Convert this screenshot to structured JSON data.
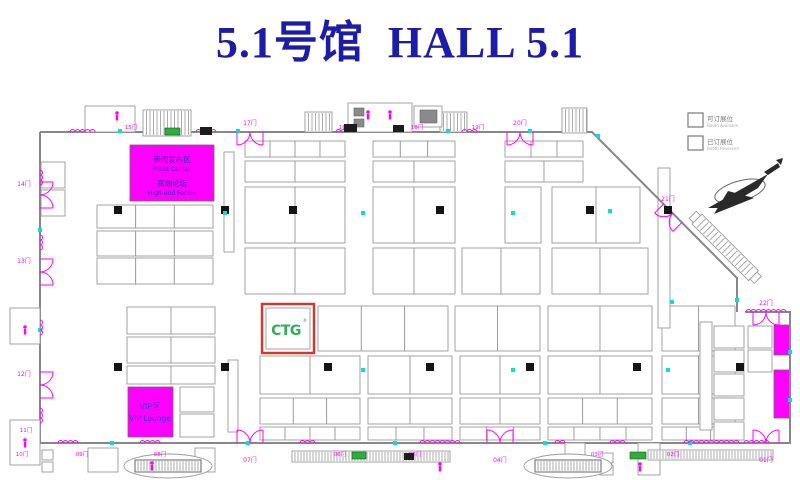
{
  "title": {
    "text": "5.1号馆  HALL 5.1",
    "color": "#1c1ca8"
  },
  "colors": {
    "title_blue": "#1c1ca8",
    "cad_magenta": "#ff00ff",
    "wall_gray": "#878787",
    "booth_gray": "#9a9a9a",
    "highlight_red": "#cf3a30",
    "ctg_green": "#2eb05a",
    "area_text_blue": "#2b2bb4",
    "cyan_marker": "#00dfe8"
  },
  "legend": {
    "items": [
      {
        "cn": "可订展位",
        "en": "Booth Available"
      },
      {
        "cn": "已订展位",
        "en": "Booth Reserved"
      }
    ]
  },
  "press_center": {
    "line1": "新闻发布区",
    "line2": "Press Center",
    "line3": "高端论坛",
    "line4": "High-end Forum"
  },
  "vip_lounge": {
    "line1": "VIP区",
    "line2": "VIP Lounge"
  },
  "ctg_booth": {
    "logo": "CTG",
    "reg": "®"
  },
  "floorplan": {
    "walls": [
      "M40,132 H592 L737,278 V312",
      "M745,312 H790 V443 H40 V132"
    ],
    "booth_rows": [
      {
        "y": 141,
        "h": 16,
        "groups": [
          [
            245,
            100,
            4
          ],
          [
            373,
            82,
            3
          ],
          [
            505,
            78,
            3
          ]
        ]
      },
      {
        "y": 161,
        "h": 21,
        "groups": [
          [
            245,
            100,
            2
          ],
          [
            373,
            82,
            2
          ],
          [
            505,
            78,
            2
          ]
        ]
      },
      {
        "y": 187,
        "h": 56,
        "groups": [
          [
            245,
            100,
            2
          ],
          [
            373,
            82,
            2
          ],
          [
            505,
            36,
            1
          ],
          [
            552,
            88,
            2
          ]
        ]
      },
      {
        "y": 248,
        "h": 46,
        "groups": [
          [
            245,
            100,
            2
          ],
          [
            373,
            82,
            2
          ],
          [
            462,
            78,
            2
          ],
          [
            552,
            96,
            2
          ]
        ]
      },
      {
        "y": 306,
        "h": 45,
        "groups": [
          [
            318,
            130,
            3
          ],
          [
            455,
            85,
            2
          ],
          [
            548,
            104,
            2
          ],
          [
            662,
            73,
            2
          ]
        ]
      },
      {
        "y": 356,
        "h": 38,
        "groups": [
          [
            260,
            100,
            2
          ],
          [
            368,
            84,
            2
          ],
          [
            460,
            80,
            2
          ],
          [
            548,
            104,
            2
          ],
          [
            662,
            73,
            2
          ]
        ]
      },
      {
        "y": 398,
        "h": 26,
        "groups": [
          [
            260,
            100,
            3
          ],
          [
            368,
            84,
            2
          ],
          [
            460,
            80,
            2
          ],
          [
            548,
            104,
            3
          ],
          [
            662,
            73,
            2
          ]
        ]
      },
      {
        "y": 427,
        "h": 13,
        "groups": [
          [
            260,
            100,
            4
          ],
          [
            368,
            84,
            3
          ],
          [
            460,
            80,
            3
          ],
          [
            548,
            104,
            4
          ],
          [
            662,
            73,
            3
          ]
        ]
      },
      {
        "y": 205,
        "h": 23,
        "groups": [
          [
            97,
            116,
            3
          ]
        ]
      },
      {
        "y": 231,
        "h": 25,
        "groups": [
          [
            97,
            116,
            3
          ]
        ]
      },
      {
        "y": 258,
        "h": 26,
        "groups": [
          [
            97,
            116,
            3
          ]
        ]
      },
      {
        "y": 307,
        "h": 27,
        "groups": [
          [
            127,
            88,
            2
          ]
        ]
      },
      {
        "y": 337,
        "h": 26,
        "groups": [
          [
            127,
            88,
            2
          ]
        ]
      },
      {
        "y": 366,
        "h": 18,
        "groups": [
          [
            127,
            88,
            2
          ]
        ]
      }
    ],
    "booths_extra": [
      [
        180,
        387,
        34,
        25
      ],
      [
        180,
        414,
        34,
        23
      ],
      [
        714,
        326,
        30,
        22
      ],
      [
        714,
        350,
        30,
        22
      ],
      [
        714,
        374,
        30,
        22
      ],
      [
        714,
        398,
        30,
        22
      ],
      [
        748,
        326,
        24,
        22
      ],
      [
        748,
        350,
        24,
        22
      ],
      [
        714,
        422,
        30,
        18
      ],
      [
        41,
        162,
        24,
        26
      ],
      [
        41,
        190,
        24,
        26
      ]
    ],
    "narrow_rects": [
      [
        224,
        152,
        10,
        100
      ],
      [
        658,
        168,
        12,
        160
      ],
      [
        228,
        360,
        10,
        72
      ],
      [
        700,
        322,
        12,
        108
      ]
    ],
    "press_rect": [
      130,
      145,
      84,
      56
    ],
    "vip_rect": [
      128,
      387,
      45,
      50
    ],
    "ctg_rect": [
      262,
      304,
      52,
      49
    ],
    "magenta_bars": [
      [
        774,
        325,
        16,
        30
      ],
      [
        774,
        370,
        16,
        48
      ]
    ],
    "hatch_blocks": [
      [
        143,
        110,
        48,
        26
      ],
      [
        305,
        112,
        27,
        20
      ],
      [
        440,
        112,
        27,
        20
      ],
      [
        562,
        108,
        25,
        25
      ]
    ],
    "structures": [
      [
        85,
        106,
        50,
        26
      ],
      [
        348,
        103,
        64,
        29
      ],
      [
        414,
        106,
        28,
        21
      ],
      [
        10,
        308,
        30,
        36
      ],
      [
        10,
        420,
        30,
        45
      ],
      [
        88,
        448,
        30,
        24
      ],
      [
        195,
        448,
        20,
        24
      ],
      [
        565,
        443,
        20,
        32
      ],
      [
        638,
        443,
        22,
        32
      ],
      [
        42,
        450,
        11,
        10
      ],
      [
        42,
        462,
        11,
        10
      ],
      [
        600,
        453,
        13,
        10
      ],
      [
        600,
        465,
        13,
        10
      ]
    ],
    "dark_rects": [
      [
        354,
        108,
        10,
        8
      ],
      [
        354,
        119,
        10,
        8
      ],
      [
        420,
        110,
        17,
        13
      ]
    ],
    "walkways": [
      [
        292,
        451,
        158,
        11
      ],
      [
        648,
        450,
        125,
        10
      ]
    ],
    "ovals": [
      [
        168,
        466,
        44,
        12
      ],
      [
        568,
        466,
        44,
        12
      ]
    ],
    "diag_escalator": {
      "x": 692,
      "y": 224,
      "w": 14,
      "len": 80
    },
    "pillars": [
      [
        118,
        210
      ],
      [
        225,
        210
      ],
      [
        293,
        210
      ],
      [
        440,
        210
      ],
      [
        590,
        210
      ],
      [
        668,
        210
      ],
      [
        118,
        367
      ],
      [
        225,
        367
      ],
      [
        328,
        367
      ],
      [
        430,
        367
      ],
      [
        530,
        367
      ],
      [
        637,
        367
      ],
      [
        740,
        367
      ]
    ],
    "cyan_dots": [
      [
        120,
        131
      ],
      [
        238,
        131
      ],
      [
        448,
        131
      ],
      [
        530,
        131
      ],
      [
        598,
        136
      ],
      [
        112,
        443
      ],
      [
        248,
        443
      ],
      [
        395,
        443
      ],
      [
        545,
        443
      ],
      [
        690,
        443
      ],
      [
        40,
        230
      ],
      [
        40,
        330
      ],
      [
        790,
        352
      ],
      [
        790,
        400
      ],
      [
        296,
        311
      ],
      [
        610,
        211
      ],
      [
        672,
        302
      ],
      [
        737,
        300
      ],
      [
        225,
        213
      ],
      [
        668,
        370
      ],
      [
        363,
        213
      ],
      [
        513,
        213
      ],
      [
        363,
        370
      ],
      [
        513,
        370
      ]
    ],
    "squiggles_h": [
      [
        70,
        132,
        26
      ],
      [
        196,
        132,
        20
      ],
      [
        336,
        132,
        16
      ],
      [
        462,
        132,
        16
      ],
      [
        58,
        443,
        24
      ],
      [
        140,
        443,
        20
      ],
      [
        300,
        443,
        16
      ],
      [
        420,
        443,
        40
      ],
      [
        555,
        443,
        14
      ],
      [
        610,
        443,
        16
      ],
      [
        684,
        443,
        56
      ],
      [
        744,
        443,
        28
      ],
      [
        746,
        312,
        40
      ]
    ],
    "squiggles_v": [
      [
        40,
        170,
        18
      ],
      [
        40,
        235,
        18
      ],
      [
        40,
        320,
        18
      ],
      [
        40,
        408,
        18
      ]
    ],
    "gates_big": [
      {
        "x": 250,
        "y": 132,
        "flip": 1,
        "rot": 0,
        "label": "17门",
        "lx": 250,
        "ly": 125
      },
      {
        "x": 520,
        "y": 132,
        "flip": 1,
        "rot": 0,
        "label": "20门",
        "lx": 520,
        "ly": 125
      },
      {
        "x": 250,
        "y": 443,
        "flip": -1,
        "rot": 0,
        "label": "07门",
        "lx": 250,
        "ly": 462
      },
      {
        "x": 500,
        "y": 443,
        "flip": -1,
        "rot": 0,
        "label": "04门",
        "lx": 500,
        "ly": 462
      },
      {
        "x": 766,
        "y": 443,
        "flip": -1,
        "rot": 0,
        "label": "01门",
        "lx": 766,
        "ly": 462
      },
      {
        "x": 766,
        "y": 312,
        "flip": 1,
        "rot": 0,
        "label": "22门",
        "lx": 766,
        "ly": 305
      },
      {
        "x": 673,
        "y": 213,
        "flip": 1,
        "rot": 45,
        "label": "21门",
        "lx": 668,
        "ly": 201
      },
      {
        "x": 40,
        "y": 195,
        "flip": 1,
        "rot": -90,
        "label": "14门",
        "lx": 24,
        "ly": 186
      },
      {
        "x": 40,
        "y": 272,
        "flip": 1,
        "rot": -90,
        "label": "13门",
        "lx": 24,
        "ly": 263
      },
      {
        "x": 40,
        "y": 385,
        "flip": 1,
        "rot": -90,
        "label": "12门",
        "lx": 24,
        "ly": 376
      }
    ],
    "doors_small": [
      {
        "x": 131,
        "y": 129,
        "label": "15门"
      },
      {
        "x": 345,
        "y": 129,
        "label": "16门"
      },
      {
        "x": 417,
        "y": 129,
        "label": "18门"
      },
      {
        "x": 478,
        "y": 129,
        "label": "19门"
      },
      {
        "x": 22,
        "y": 456,
        "label": "10门"
      },
      {
        "x": 82,
        "y": 456,
        "label": "09门"
      },
      {
        "x": 160,
        "y": 456,
        "label": "08门"
      },
      {
        "x": 340,
        "y": 456,
        "label": "06门"
      },
      {
        "x": 415,
        "y": 456,
        "label": "05门"
      },
      {
        "x": 597,
        "y": 456,
        "label": "03门"
      },
      {
        "x": 673,
        "y": 456,
        "label": "02门"
      },
      {
        "x": 26,
        "y": 432,
        "label": "11门"
      }
    ],
    "green_boxes": [
      [
        165,
        128,
        15,
        7
      ],
      [
        630,
        452,
        16,
        7
      ],
      [
        352,
        452,
        14,
        7
      ]
    ],
    "black_marks": [
      [
        200,
        127,
        12,
        8
      ],
      [
        344,
        124,
        13,
        8
      ],
      [
        393,
        125,
        11,
        7
      ],
      [
        404,
        453,
        10,
        7
      ]
    ],
    "persons": [
      [
        117,
        113
      ],
      [
        368,
        112
      ],
      [
        390,
        112
      ],
      [
        152,
        463
      ],
      [
        440,
        464
      ],
      [
        640,
        464
      ],
      [
        25,
        327
      ],
      [
        25,
        440
      ]
    ]
  }
}
